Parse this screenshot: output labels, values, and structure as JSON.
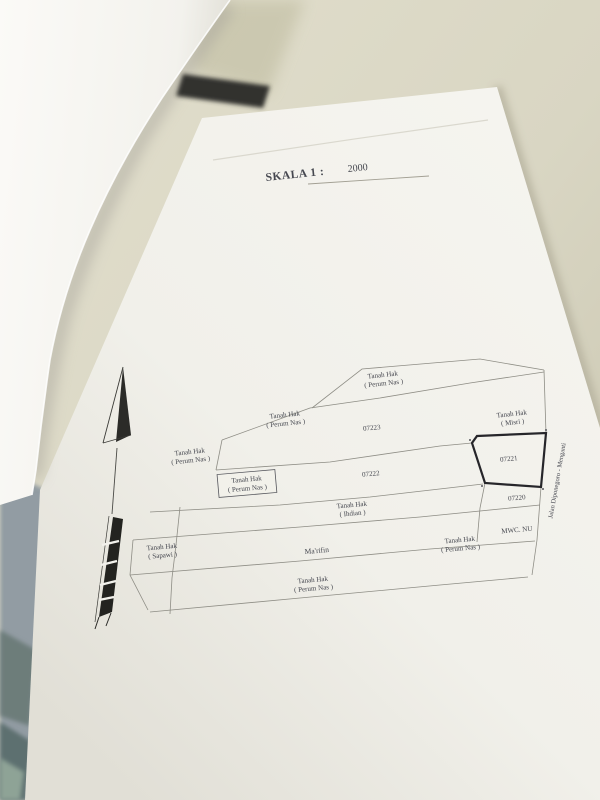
{
  "scale": {
    "label": "SKALA 1 :",
    "value": "2000"
  },
  "map": {
    "labels": {
      "top_perum": {
        "line1": "Tanah Hak",
        "line2": "( Perum Nas )"
      },
      "upper_left_perum": {
        "line1": "Tanah Hak",
        "line2": "( Perum Nas )"
      },
      "left_perum": {
        "line1": "Tanah Hak",
        "line2": "( Perum Nas )"
      },
      "boxed_perum": {
        "line1": "Tanah Hak",
        "line2": "( Perum Nas )"
      },
      "misri": {
        "line1": "Tanah Hak",
        "line2": "( Misri )"
      },
      "ihdian": {
        "line1": "Tanah Hak",
        "line2": "( Ihdian )"
      },
      "sapawi": {
        "line1": "Tanah Hak",
        "line2": "( Sapawi )"
      },
      "right_perum": {
        "line1": "Tanah Hak",
        "line2": "( Perum Nas )"
      },
      "bottom_perum": {
        "line1": "Tanah Hak",
        "line2": "( Perum Nas )"
      },
      "marifin": "Ma'rifin",
      "mwc": "MWC. NU",
      "road": "Jalan  Diponegoro - Menganti"
    },
    "parcel_numbers": {
      "p07223": "07223",
      "p07222": "07222",
      "p07221": "07221",
      "p07220": "07220"
    }
  },
  "colors": {
    "paper": "#f4f3ee",
    "background": "#d9d6c3",
    "map_line": "#8e8d85",
    "bold_parcel": "#26262a",
    "ink": "#45474f"
  }
}
